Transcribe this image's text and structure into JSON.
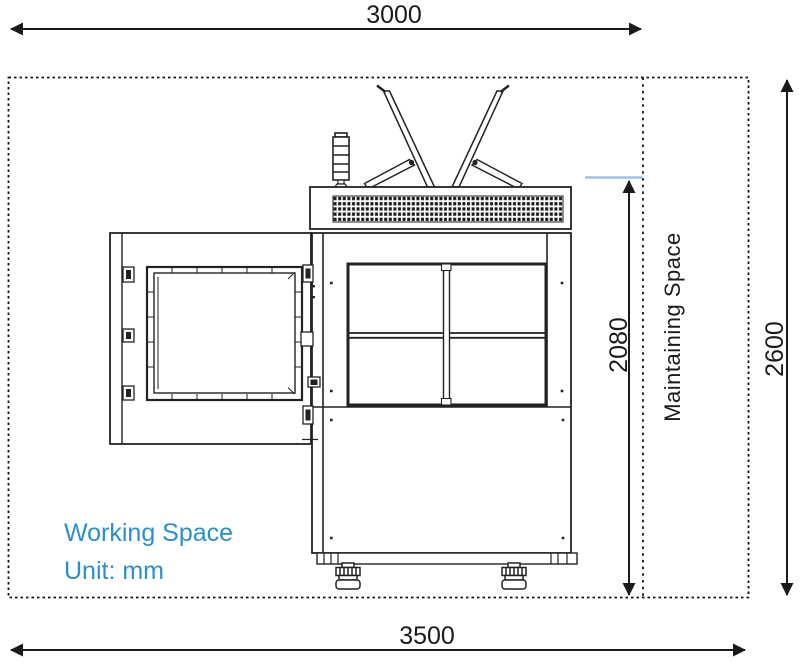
{
  "diagram": {
    "dimensions": {
      "working_width": "3000",
      "total_width": "3500",
      "total_height": "2600",
      "machine_height": "2080"
    },
    "labels": {
      "maintaining_space": "Maintaining Space",
      "working_space": "Working Space",
      "unit": "Unit: mm"
    },
    "colors": {
      "accent_blue": "#2b8fcb",
      "reference_line_blue": "#9dc3e6",
      "line_dark": "#1a1a1a"
    }
  }
}
